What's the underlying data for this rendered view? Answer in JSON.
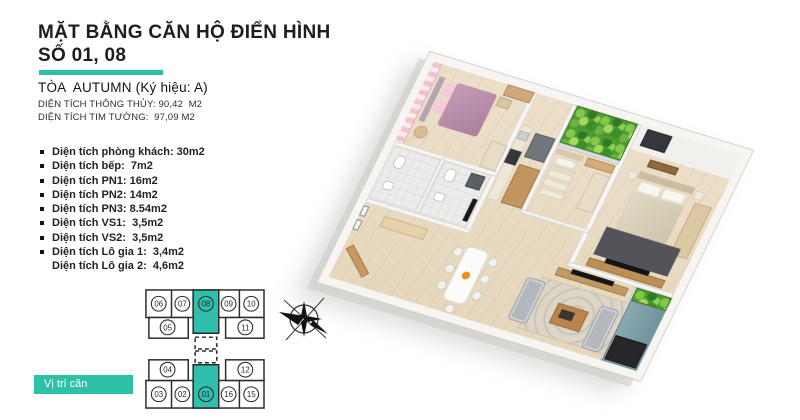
{
  "header": {
    "title_line1": "MẶT BẰNG CĂN HỘ ĐIỂN HÌNH",
    "title_line2": "SỐ 01, 08",
    "building_line": "TÒA  AUTUMN (Ký hiệu: A)",
    "net_area_line": "DIỆN TÍCH THÔNG THỦY: 90,42  M2",
    "gross_area_line": "DIỆN TÍCH TIM TƯỜNG:  97,09 M2"
  },
  "room_list": {
    "items": [
      "Diện tích phòng khách: 30m2",
      "Diện tích bếp:  7m2",
      "Diện tích PN1: 16m2",
      "Diện tích PN2: 14m2",
      "Diện tích PN3: 8.54m2",
      "Diện tích VS1:  3,5m2",
      "Diện tích VS2:  3,5m2",
      "Diện tích Lô gia 1:  3,4m2",
      "Diện tích Lô gia 2:  4,6m2"
    ]
  },
  "unit_map": {
    "cells": [
      "06",
      "07",
      "08",
      "09",
      "10",
      "05",
      "11",
      "04",
      "12",
      "03",
      "02",
      "01",
      "16",
      "15"
    ],
    "highlighted": [
      "08",
      "01"
    ],
    "location_label": "Vị trí căn"
  },
  "colors": {
    "accent_teal": "#2cc0a7",
    "unit_highlight": "#2fbfac",
    "title_text": "#1d1d1b",
    "plan_wood_floor": "#e9dcc6",
    "plan_pink_wall": "#f2c3cf",
    "plan_pink_bed": "#b78da9",
    "plan_green_garden": "#4e9a31",
    "plan_sofa_grey": "#b4b8be",
    "plan_balcony_floor": "#7ea1aa",
    "plan_dark_rug": "#53545a"
  }
}
